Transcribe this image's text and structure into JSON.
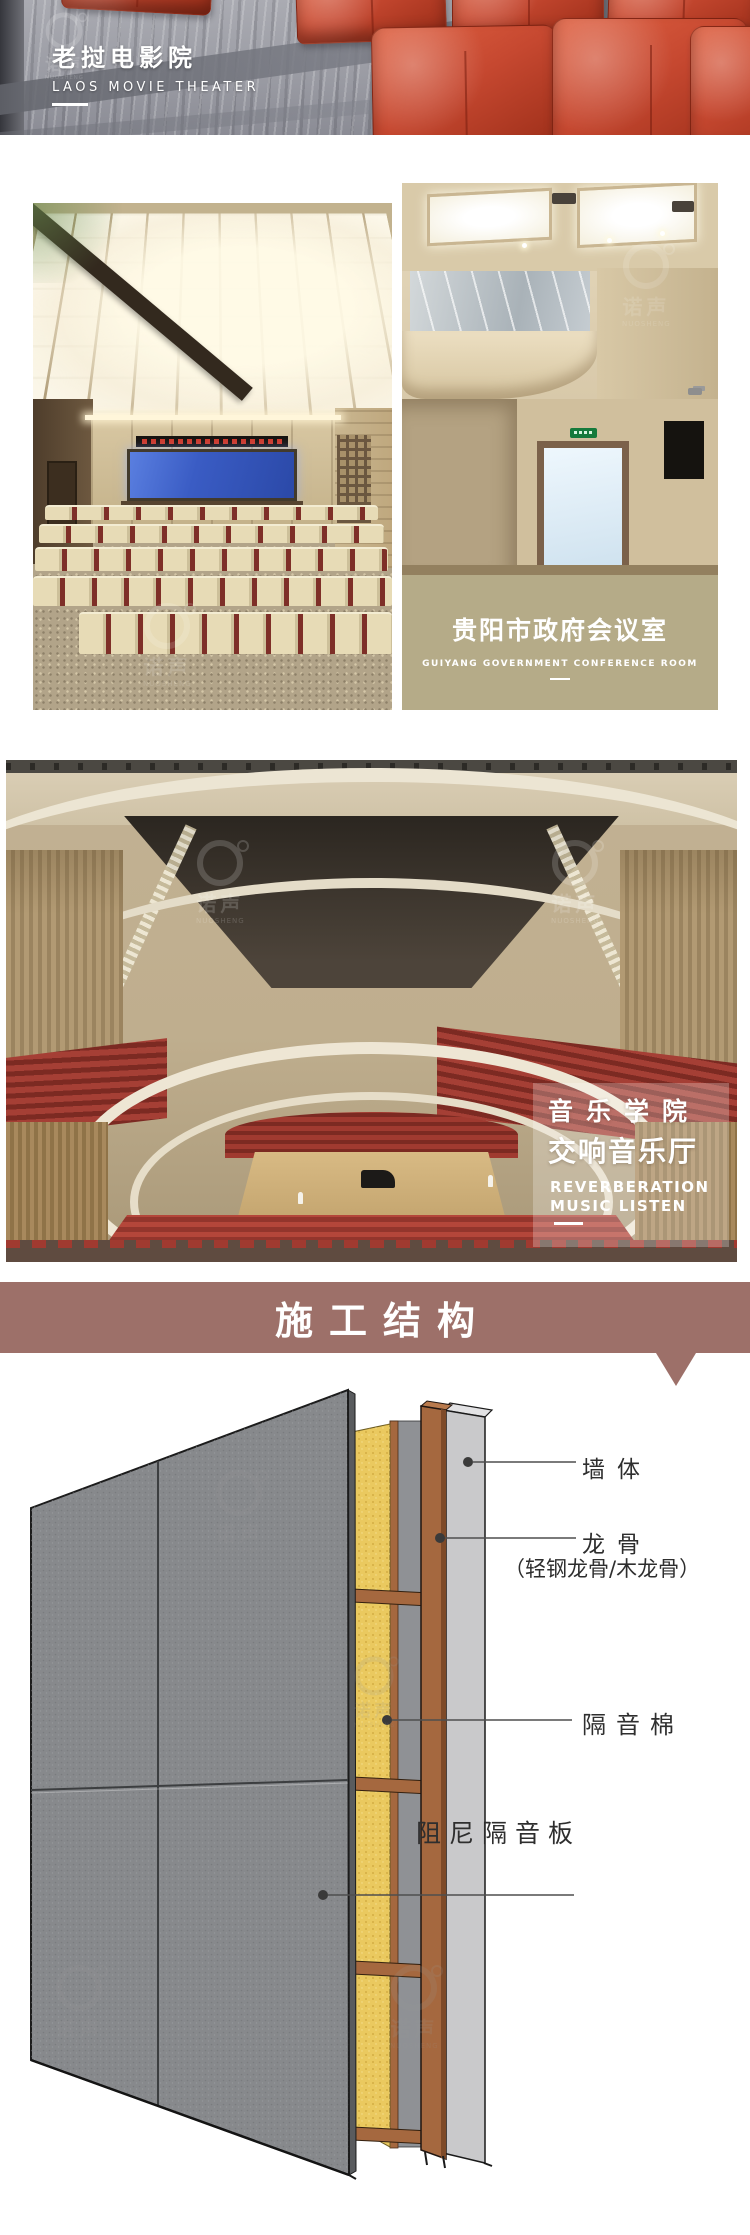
{
  "brand_watermark": {
    "cn": "诺声",
    "en": "NUOSHENG"
  },
  "hero_banner": {
    "title": "老挝电影院",
    "subtitle": "LAOS MOVIE THEATER"
  },
  "conference_caption": {
    "title": "贵阳市政府会议室",
    "subtitle": "GUIYANG GOVERNMENT CONFERENCE ROOM"
  },
  "concert_overlay": {
    "title_line1": "音乐学院",
    "title_line2": "交响音乐厅",
    "en_line1": "REVERBERATION",
    "en_line2": "MUSIC LISTEN"
  },
  "construction_header": {
    "title": "施工结构"
  },
  "diagram": {
    "label_wall": "墙体",
    "label_keel": "龙骨",
    "label_keel_sub": "（轻钢龙骨/木龙骨）",
    "label_insulation": "隔音棉",
    "label_damping_board": "阻尼隔音板"
  },
  "colors": {
    "header_banner": "#9d7069",
    "caption_box": "#b5ab88",
    "keel_brown": "#a5683f",
    "insulation_yellow": "#eac95f",
    "panel_gray": "#87898c",
    "sofa_red": "#c64830"
  }
}
